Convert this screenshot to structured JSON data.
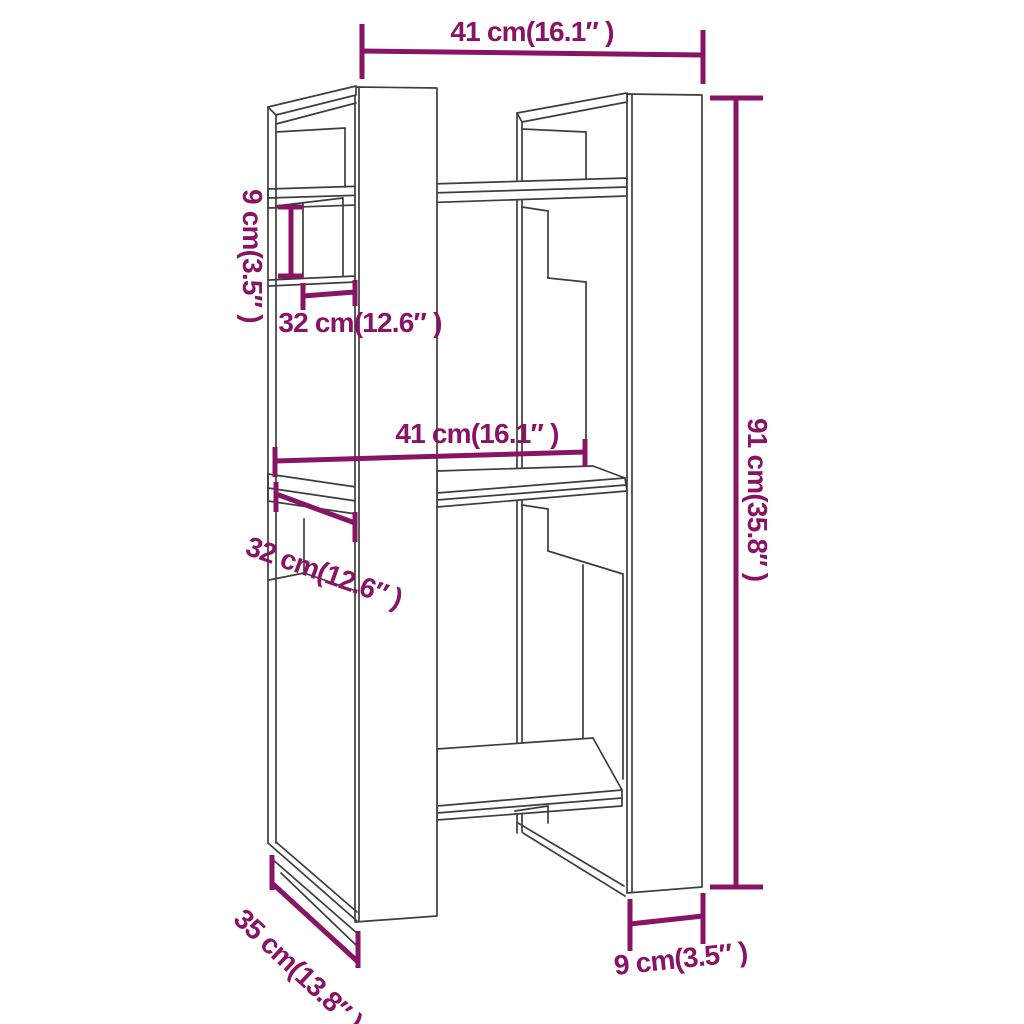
{
  "diagram": {
    "type": "furniture-dimension-drawing",
    "subject": "book cabinet / room divider wireframe",
    "background_color": "#ffffff",
    "wireframe_color": "#3e3e3e",
    "dimension_color": "#871464",
    "labels": {
      "top_width": "41 cm(16.1″ )",
      "height": "91 cm(35.8″ )",
      "gap_height": "9 cm(3.5″ )",
      "upper_back_width": "32 cm(12.6″ )",
      "middle_width": "41 cm(16.1″ )",
      "lower_back_width": "32 cm(12.6″ )",
      "depth": "35 cm(13.8″ )",
      "panel_width": "9 cm(3.5″ )"
    }
  }
}
